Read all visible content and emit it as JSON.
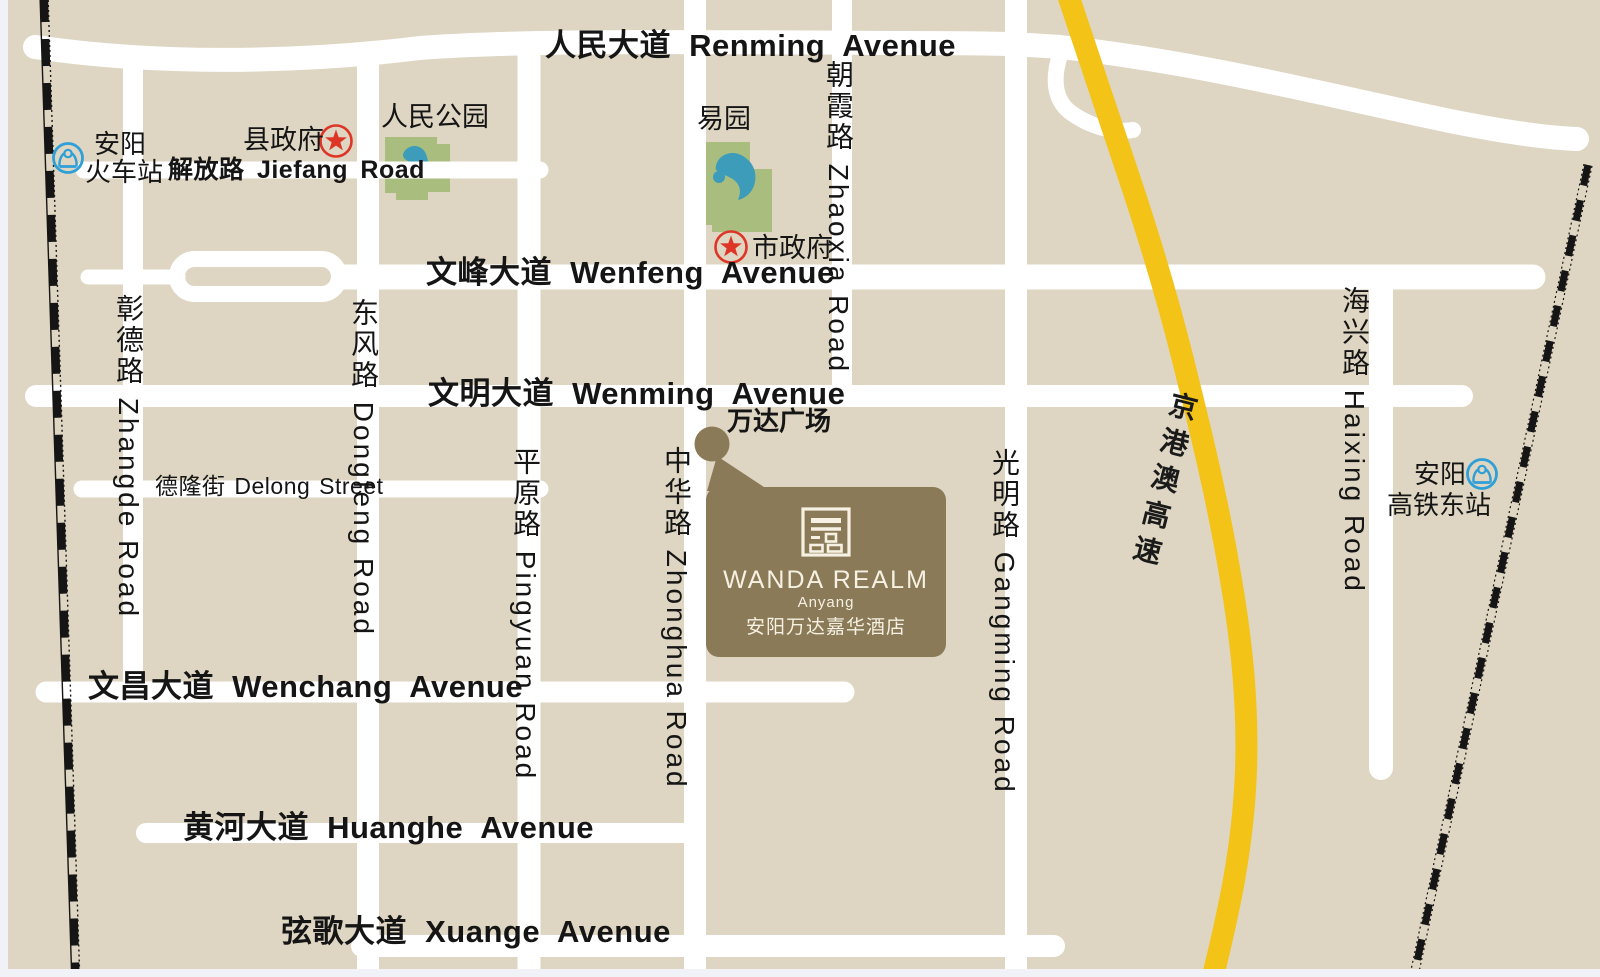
{
  "colors": {
    "background": "#ded6c2",
    "road": "#ffffff",
    "expressway_yellow": "#f3c318",
    "park_green": "#a9bd7e",
    "water_blue": "#3d9cba",
    "railway_black": "#151515",
    "callout_brown": "#8a7a58",
    "callout_text": "#f6f1e2",
    "label_text": "#151515",
    "star_red": "#dd3526",
    "station_blue": "#2f9fd8"
  },
  "roads": {
    "renming": {
      "label": "人民大道 Renming Avenue"
    },
    "wenfeng": {
      "label": "文峰大道 Wenfeng Avenue"
    },
    "wenming": {
      "label": "文明大道 Wenming Avenue"
    },
    "wenchang": {
      "label": "文昌大道 Wenchang Avenue"
    },
    "huanghe": {
      "label": "黄河大道 Huanghe Avenue"
    },
    "xuange": {
      "label": "弦歌大道 Xuange Avenue"
    },
    "jiefang": {
      "label": "解放路 Jiefang Road"
    },
    "delong": {
      "label": "德隆街 Delong Street"
    },
    "zhangde": {
      "label": "彰德路 Zhangde Road"
    },
    "dongfeng": {
      "label": "东风路 Dongfeng Road"
    },
    "pingyuan": {
      "label": "平原路 Pingyuan Road"
    },
    "zhonghua": {
      "label": "中华路 Zhonghua Road"
    },
    "zhaoxia": {
      "label": "朝霞路 Zhaoxia Road"
    },
    "gangming": {
      "label": "光明路 Gangming Road"
    },
    "haixing": {
      "label": "海兴路 Haixing Road"
    },
    "expressway": {
      "label": "京港澳高速"
    }
  },
  "pois": {
    "railway_station": {
      "line1": "安阳",
      "line2": "火车站"
    },
    "hsr_station": {
      "line1": "安阳",
      "line2": "高铁东站"
    },
    "county_gov": {
      "label": "县政府"
    },
    "city_gov": {
      "label": "市政府"
    },
    "renmin_park": {
      "label": "人民公园"
    },
    "yi_garden": {
      "label": "易园"
    },
    "wanda_plaza": {
      "label": "万达广场"
    }
  },
  "callout": {
    "brand": "WANDA REALM",
    "location": "Anyang",
    "name_zh": "安阳万达嘉华酒店"
  }
}
